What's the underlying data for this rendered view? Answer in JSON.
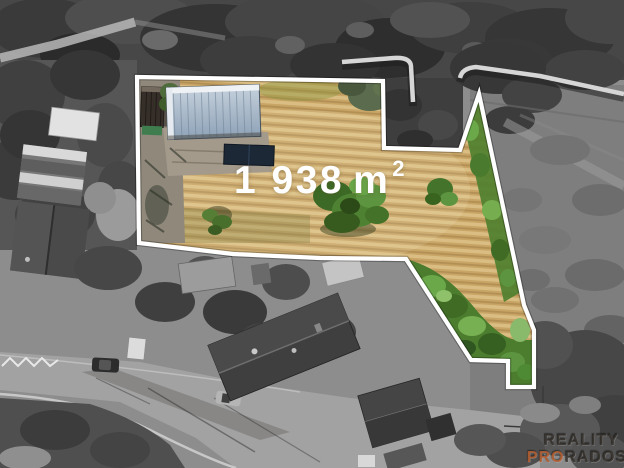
{
  "property": {
    "area_value": "1 938",
    "area_unit": "m",
    "area_exponent": "2",
    "area_full_label": "1 938 m²",
    "boundary_color": "#ffffff",
    "boundary_points": "137,77 383,81 384,148 460,150 479,94 524,305 534,330 534,387 508,387 508,361 471,360 406,259 320,258 233,254 139,243"
  },
  "watermark": {
    "line1": "REALITY",
    "line2_accent": "PRO",
    "line2_rest": "RADOST",
    "accent_color": "#b45a2c"
  },
  "palette": {
    "field_tan": "#c8a465",
    "vegetation_green": "#4e8232",
    "roof_blue": "#a9bacb",
    "dark_roof": "#362f29",
    "surroundings_gray": "#8d8d8d",
    "boundary_white": "#ffffff"
  }
}
